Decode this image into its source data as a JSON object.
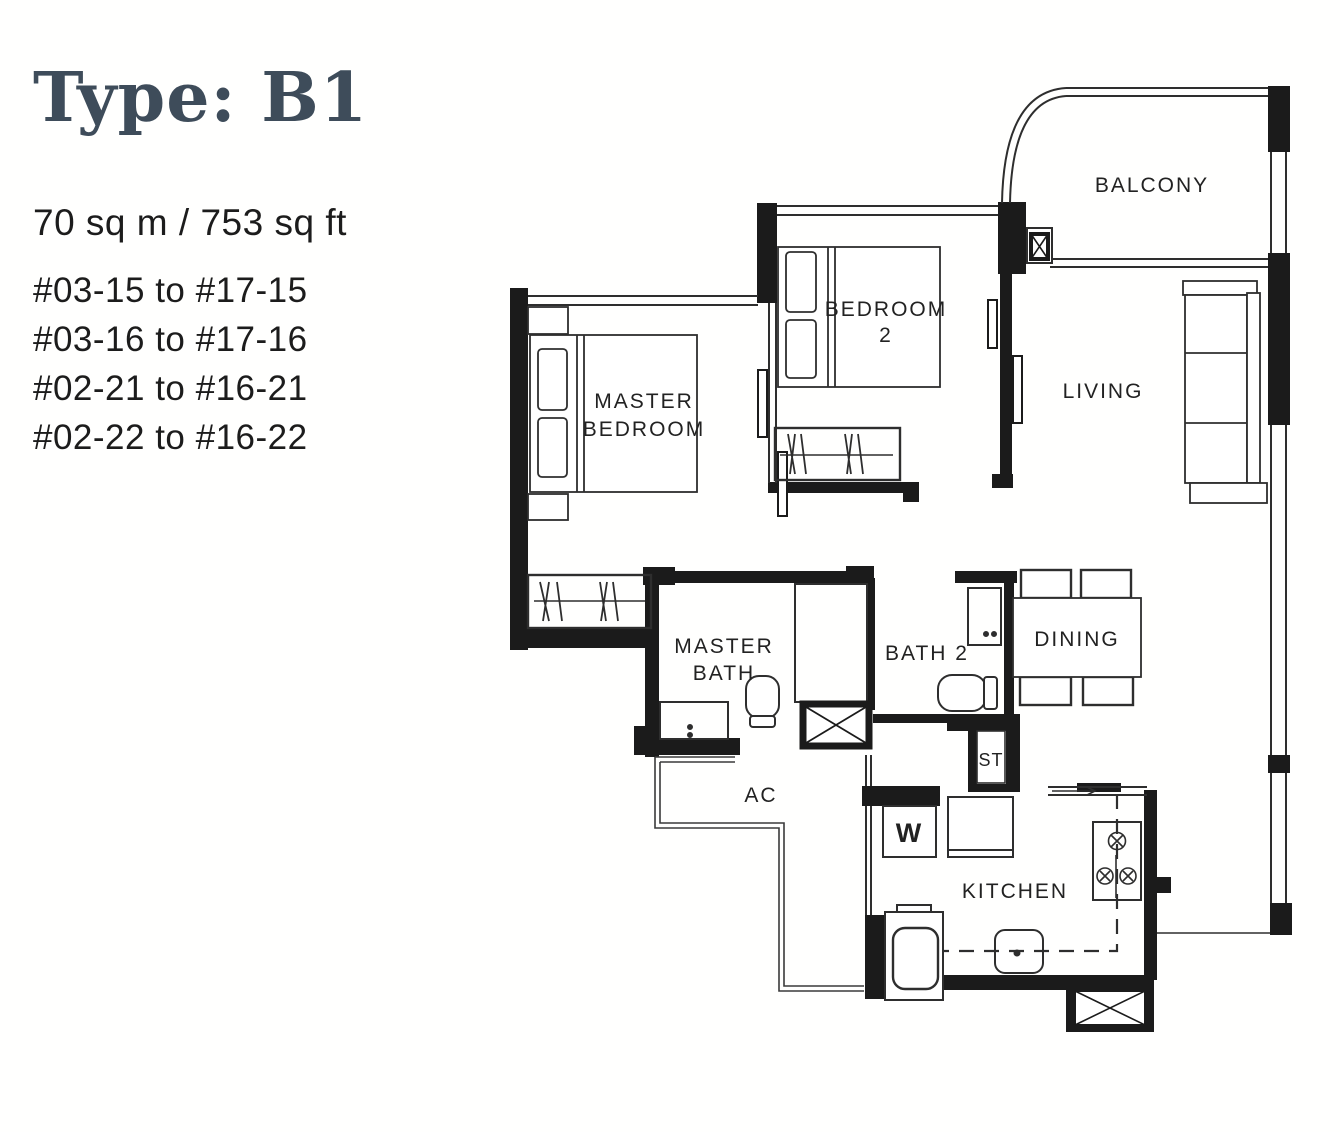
{
  "header": {
    "title": "Type: B1",
    "area": "70 sq m / 753 sq ft",
    "unit_ranges": [
      "#03-15 to #17-15",
      "#03-16 to #17-16",
      "#02-21 to #16-21",
      "#02-22 to #16-22"
    ]
  },
  "plan": {
    "labels": {
      "balcony": "BALCONY",
      "bedroom2_line1": "BEDROOM",
      "bedroom2_line2": "2",
      "living": "LIVING",
      "master_bedroom_line1": "MASTER",
      "master_bedroom_line2": "BEDROOM",
      "master_bath_line1": "MASTER",
      "master_bath_line2": "BATH",
      "bath2": "BATH 2",
      "dining": "DINING",
      "ac_ledge": "AC",
      "storage": "ST",
      "washer": "W",
      "kitchen": "KITCHEN"
    },
    "colors": {
      "wall": "#1b1b1b",
      "line": "#2e2e2e",
      "title": "#3e4c5a",
      "text": "#1c1c1c"
    }
  }
}
